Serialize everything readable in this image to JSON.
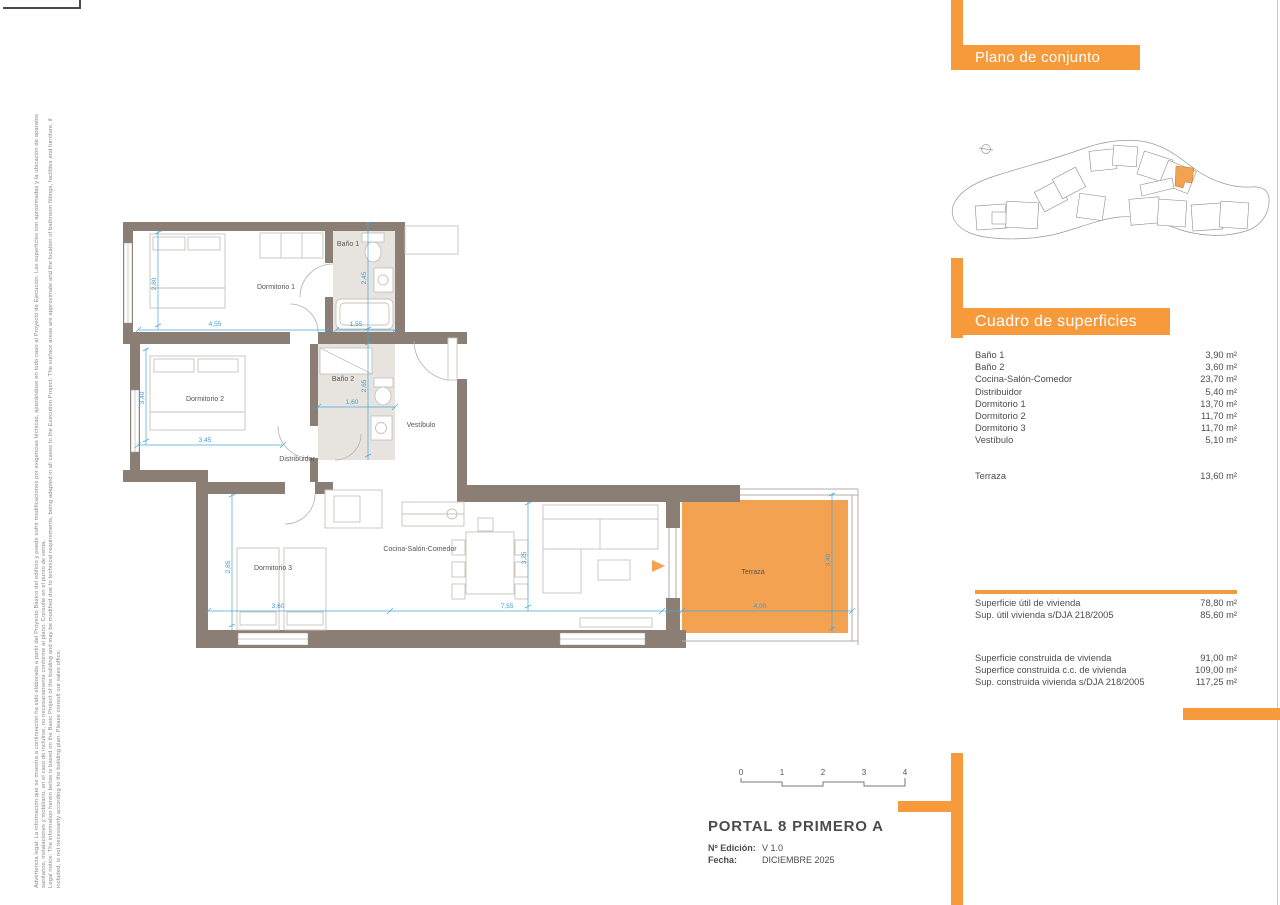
{
  "colors": {
    "accent": "#F79A3C",
    "terrace_fill": "#F2A251",
    "wall": "#8B7E74",
    "dimension_blue": "#3D9BD1"
  },
  "legal": {
    "es_line1": "Advertencia legal: La información que se muestra a continuación ha sido elaborada a partir del Proyecto Básico del edificio y puede sufrir modificaciones por exigencias técnicas, ajustándose en todo caso al Proyecto de Ejecución. Las superficies son aproximadas y la ubicación de aparatos",
    "es_line2": "sanitarios, instalaciones y mobiliario, en el caso de incluirse, no necesariamente conforme al plano. Consulte en el punto de venta.",
    "en_line1": "Legal notice: The information herein below is based on the Basic Project of the building and may be modified due to technical requirements, being adapted in all cases to the Execution Project. The surface areas are approximate and the location of bathroom fittings, facilities and furniture, if",
    "en_line2": "included, is not necessarily according to the building plan. Please consult our sales office."
  },
  "site_plan": {
    "title": "Plano de conjunto"
  },
  "surfaces": {
    "title": "Cuadro de superficies",
    "rows": [
      {
        "label": "Baño 1",
        "value": "3,90 m²"
      },
      {
        "label": "Baño 2",
        "value": "3,60 m²"
      },
      {
        "label": "Cocina-Salón-Comedor",
        "value": "23,70 m²"
      },
      {
        "label": "Distribuidor",
        "value": "5,40 m²"
      },
      {
        "label": "Dormitorio 1",
        "value": "13,70 m²"
      },
      {
        "label": "Dormitorio 2",
        "value": "11,70 m²"
      },
      {
        "label": "Dormitorio 3",
        "value": "11,70 m²"
      },
      {
        "label": "Vestíbulo",
        "value": "5,10 m²"
      }
    ],
    "terraza": {
      "label": "Terraza",
      "value": "13,60 m²"
    },
    "utiles": [
      {
        "label": "Superficie útil de vivienda",
        "value": "78,80 m²"
      },
      {
        "label": "Sup. útil vivienda s/DJA 218/2005",
        "value": "85,60 m²"
      }
    ],
    "construidas": [
      {
        "label": "Superficie construida de vivienda",
        "value": "91,00 m²"
      },
      {
        "label": "Superfice construida c.c. de vivienda",
        "value": "109,00 m²"
      },
      {
        "label": "Sup. construida vivienda s/DJA 218/2005",
        "value": "117,25 m²"
      }
    ]
  },
  "floor_plan": {
    "rooms": {
      "dorm1": "Dormitorio 1",
      "bano1": "Baño 1",
      "dorm2": "Dormitorio 2",
      "bano2": "Baño 2",
      "vestibulo": "Vestíbulo",
      "distribuidor": "Distribuidor",
      "dorm3": "Dormitorio 3",
      "cocina": "Cocina-Salón-Comedor",
      "terraza": "Terraza"
    },
    "dims": {
      "dorm1_w": "4,55",
      "dorm1_h": "2,80",
      "bano1_w": "1,55",
      "bano1_h": "2,45",
      "dorm2_w": "3,45",
      "dorm2_h": "3,40",
      "bano2_w": "1,60",
      "bano2_h": "2,65",
      "dorm3_w": "3,60",
      "dorm3_h": "2,85",
      "salon_w": "7,55",
      "salon_h": "3,25",
      "terraza_w": "4,00",
      "terraza_h": "3,40"
    }
  },
  "scale_bar": {
    "ticks": [
      "0",
      "1",
      "2",
      "3",
      "4"
    ]
  },
  "title_block": {
    "title": "PORTAL 8 PRIMERO A",
    "edition_label": "Nº Edición:",
    "edition_value": "V 1.0",
    "date_label": "Fecha:",
    "date_value": "DICIEMBRE 2025"
  }
}
